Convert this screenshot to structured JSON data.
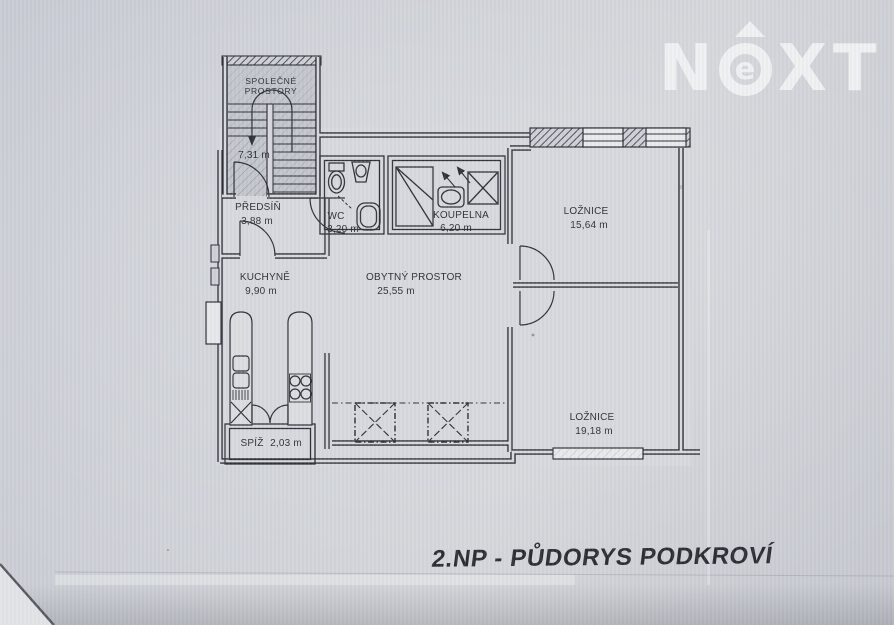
{
  "page": {
    "caption": "2.NP - PŮDORYS PODKROVÍ"
  },
  "logo": {
    "letter_n": "N",
    "letter_e": "e",
    "letter_x": "X",
    "letter_t": "T"
  },
  "rooms": {
    "common": {
      "line1": "SPOLEČNÉ",
      "line2": "PROSTORY"
    },
    "landing": {
      "area": "7,31 m"
    },
    "predsin": {
      "name": "PŘEDSÍŇ",
      "area": "3,88 m"
    },
    "wc": {
      "name": "WC",
      "area": "3,20 m"
    },
    "koupelna": {
      "name": "KOUPELNA",
      "area": "6,20 m"
    },
    "loznice1": {
      "name": "LOŽNICE",
      "area": "15,64 m"
    },
    "kuchyne": {
      "name": "KUCHYNĚ",
      "area": "9,90 m"
    },
    "obytny": {
      "name": "OBYTNÝ PROSTOR",
      "area": "25,55 m"
    },
    "loznice2": {
      "name": "LOŽNICE",
      "area": "19,18 m"
    },
    "spiz": {
      "name": "SPÍŽ",
      "area": "2,03 m"
    }
  },
  "colors": {
    "paper": "#cdd0d6",
    "ink": "#2e3238",
    "logo_white": "#f1f2f4",
    "stair_fill": "#c3c6cd",
    "room_fill": "#d6d8dd"
  }
}
